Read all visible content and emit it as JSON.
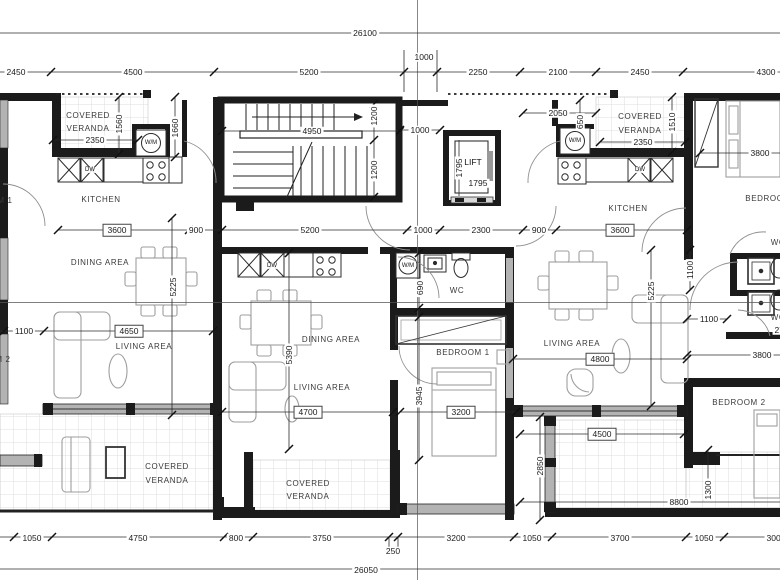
{
  "drawing": {
    "type": "apartment-floor-plan",
    "overall_width_top": "26100",
    "overall_width_bottom": "26050"
  },
  "colors": {
    "wall": "#1b1b1b",
    "window_fill": "#b3b3b3",
    "tile_line": "#dcdcdc",
    "furniture_line": "#9e9e9e",
    "dim_line": "#2b2b2b",
    "label_text": "#1f1f1f",
    "background": "#ffffff"
  },
  "dimension_labels": [
    {
      "t": "26100",
      "x": 365,
      "y": 33
    },
    {
      "t": "2450",
      "x": 16,
      "y": 72
    },
    {
      "t": "4500",
      "x": 133,
      "y": 72
    },
    {
      "t": "5200",
      "x": 309,
      "y": 72
    },
    {
      "t": "1000",
      "x": 424,
      "y": 57
    },
    {
      "t": "2250",
      "x": 478,
      "y": 72
    },
    {
      "t": "2100",
      "x": 558,
      "y": 72
    },
    {
      "t": "2450",
      "x": 640,
      "y": 72
    },
    {
      "t": "4300",
      "x": 766,
      "y": 72
    },
    {
      "t": "2350",
      "x": 95,
      "y": 140
    },
    {
      "t": "1560",
      "x": 119,
      "y": 124,
      "r": 1
    },
    {
      "t": "1660",
      "x": 175,
      "y": 128,
      "r": 1
    },
    {
      "t": "3600",
      "x": 117,
      "y": 230,
      "b": 1
    },
    {
      "t": "900",
      "x": 196,
      "y": 230
    },
    {
      "t": "4950",
      "x": 312,
      "y": 131
    },
    {
      "t": "1200",
      "x": 374,
      "y": 116,
      "r": 1
    },
    {
      "t": "1200",
      "x": 374,
      "y": 170,
      "r": 1
    },
    {
      "t": "1000",
      "x": 420,
      "y": 130
    },
    {
      "t": "2050",
      "x": 558,
      "y": 113
    },
    {
      "t": "650",
      "x": 580,
      "y": 122,
      "r": 1
    },
    {
      "t": "2350",
      "x": 643,
      "y": 142
    },
    {
      "t": "1510",
      "x": 672,
      "y": 122,
      "r": 1
    },
    {
      "t": "3800",
      "x": 760,
      "y": 153
    },
    {
      "t": "1795",
      "x": 459,
      "y": 168,
      "r": 1
    },
    {
      "t": "1795",
      "x": 478,
      "y": 183
    },
    {
      "t": "5200",
      "x": 310,
      "y": 230
    },
    {
      "t": "1000",
      "x": 423,
      "y": 230
    },
    {
      "t": "2300",
      "x": 481,
      "y": 230
    },
    {
      "t": "900",
      "x": 539,
      "y": 230
    },
    {
      "t": "3600",
      "x": 620,
      "y": 230,
      "b": 1
    },
    {
      "t": "1100",
      "x": 24,
      "y": 331
    },
    {
      "t": "4650",
      "x": 129,
      "y": 331,
      "b": 1
    },
    {
      "t": "5225",
      "x": 173,
      "y": 287,
      "r": 1
    },
    {
      "t": "5390",
      "x": 289,
      "y": 355,
      "r": 1
    },
    {
      "t": "690",
      "x": 420,
      "y": 288,
      "r": 1
    },
    {
      "t": "3945",
      "x": 419,
      "y": 396,
      "r": 1
    },
    {
      "t": "5225",
      "x": 651,
      "y": 291,
      "r": 1
    },
    {
      "t": "1100",
      "x": 690,
      "y": 270,
      "r": 1
    },
    {
      "t": "1100",
      "x": 709,
      "y": 319
    },
    {
      "t": "2750",
      "x": 784,
      "y": 330
    },
    {
      "t": "4800",
      "x": 600,
      "y": 359,
      "b": 1
    },
    {
      "t": "3800",
      "x": 762,
      "y": 355
    },
    {
      "t": "4700",
      "x": 308,
      "y": 412,
      "b": 1
    },
    {
      "t": "3200",
      "x": 461,
      "y": 412,
      "b": 1
    },
    {
      "t": "2850",
      "x": 540,
      "y": 466,
      "r": 1
    },
    {
      "t": "4500",
      "x": 602,
      "y": 434,
      "b": 1
    },
    {
      "t": "1300",
      "x": 708,
      "y": 490,
      "r": 1
    },
    {
      "t": "8800",
      "x": 679,
      "y": 502
    },
    {
      "t": "1050",
      "x": 32,
      "y": 538
    },
    {
      "t": "4750",
      "x": 138,
      "y": 538
    },
    {
      "t": "800",
      "x": 236,
      "y": 538
    },
    {
      "t": "3750",
      "x": 322,
      "y": 538
    },
    {
      "t": "250",
      "x": 393,
      "y": 551
    },
    {
      "t": "3200",
      "x": 456,
      "y": 538
    },
    {
      "t": "1050",
      "x": 532,
      "y": 538
    },
    {
      "t": "3700",
      "x": 620,
      "y": 538
    },
    {
      "t": "1050",
      "x": 704,
      "y": 538
    },
    {
      "t": "3000",
      "x": 776,
      "y": 538
    },
    {
      "t": "26050",
      "x": 366,
      "y": 570
    }
  ],
  "room_labels": [
    {
      "t": "COVERED",
      "x": 88,
      "y": 116
    },
    {
      "t": "VERANDA",
      "x": 88,
      "y": 129
    },
    {
      "t": "KITCHEN",
      "x": 101,
      "y": 200
    },
    {
      "t": "DINING AREA",
      "x": 100,
      "y": 263
    },
    {
      "t": "LIVING AREA",
      "x": 144,
      "y": 347
    },
    {
      "t": "COVERED",
      "x": 167,
      "y": 467
    },
    {
      "t": "VERANDA",
      "x": 167,
      "y": 481
    },
    {
      "t": "DINING AREA",
      "x": 331,
      "y": 340
    },
    {
      "t": "LIVING AREA",
      "x": 322,
      "y": 388
    },
    {
      "t": "WC",
      "x": 457,
      "y": 291
    },
    {
      "t": "BEDROOM 1",
      "x": 463,
      "y": 353
    },
    {
      "t": "COVERED",
      "x": 308,
      "y": 484
    },
    {
      "t": "VERANDA",
      "x": 308,
      "y": 497
    },
    {
      "t": "COVERED",
      "x": 640,
      "y": 117
    },
    {
      "t": "VERANDA",
      "x": 640,
      "y": 131
    },
    {
      "t": "KITCHEN",
      "x": 628,
      "y": 209
    },
    {
      "t": "LIVING AREA",
      "x": 572,
      "y": 344
    },
    {
      "t": "BEDROOM 1",
      "x": 772,
      "y": 199
    },
    {
      "t": "WC",
      "x": 778,
      "y": 243
    },
    {
      "t": "WC",
      "x": 778,
      "y": 318
    },
    {
      "t": "BEDROOM 2",
      "x": 739,
      "y": 403
    },
    {
      "t": "M 1",
      "x": 5,
      "y": 201
    },
    {
      "t": "M 2",
      "x": 3,
      "y": 360
    }
  ],
  "fixture_labels": [
    {
      "t": "W/M",
      "x": 151,
      "y": 143
    },
    {
      "t": "DW",
      "x": 90,
      "y": 170
    },
    {
      "t": "DW",
      "x": 272,
      "y": 266
    },
    {
      "t": "W/M",
      "x": 408,
      "y": 266
    },
    {
      "t": "W/M",
      "x": 575,
      "y": 141
    },
    {
      "t": "DW",
      "x": 640,
      "y": 170
    },
    {
      "t": "LIFT",
      "x": 473,
      "y": 162,
      "s": 8.5
    }
  ]
}
